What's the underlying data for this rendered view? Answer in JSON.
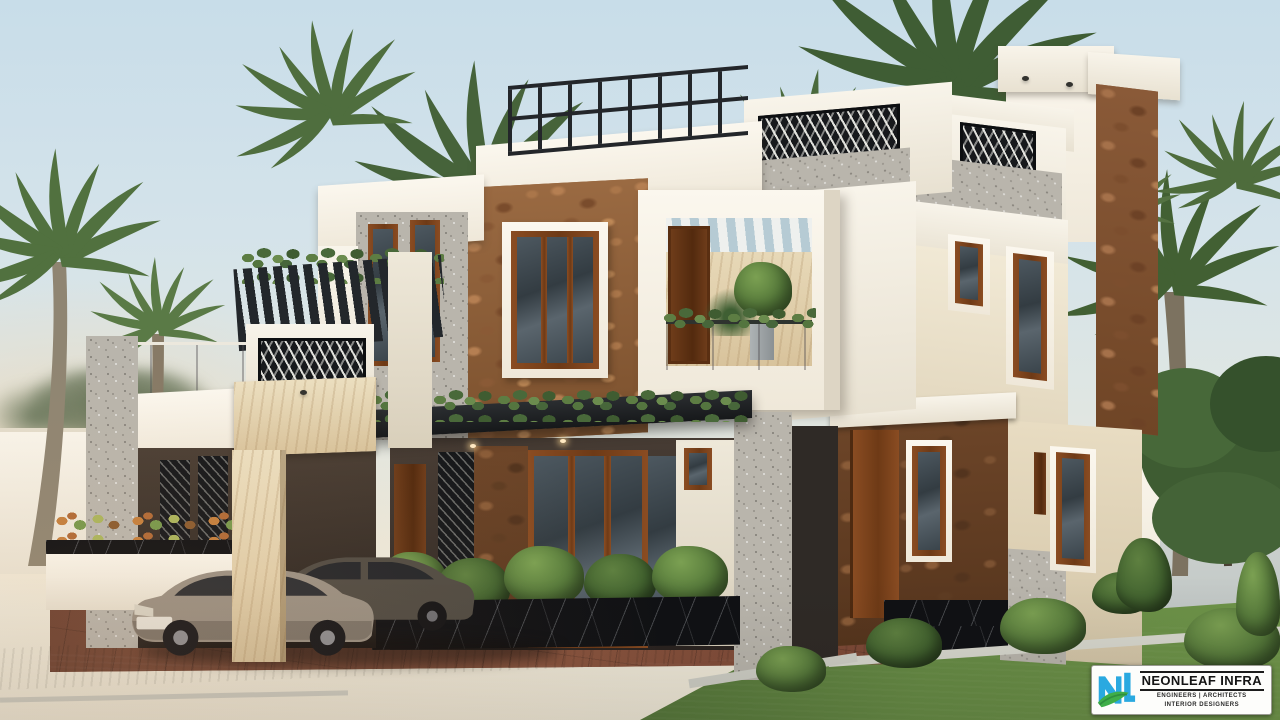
{
  "scene": {
    "label": "Photorealistic 3D exterior render of a modern two-storey residence at dusk",
    "setting": "Tropical landscaping with palm trees, lawn, stone-clad facade, carport with two cars, driveway and asphalt road"
  },
  "palette": {
    "sky_top": "#cbdfe9",
    "sky_horizon": "#f0e9d8",
    "wall_white": "#f4efe4",
    "wall_cream": "#ecdfc6",
    "stone_brown": "#8a5a38",
    "timber_brown": "#7c431d",
    "screen_black": "#1a1d20",
    "window_glass": "#39424a",
    "marble_beige": "#e6d6b4",
    "black_marble": "#101114",
    "lawn_green": "#5d8140",
    "road_asphalt": "#2c2f31",
    "paver_brown": "#7c4836",
    "car_grey": "#9a9083",
    "logo_blue": "#2aa9e0",
    "logo_green": "#3fae49"
  },
  "watermark": {
    "monogram": "NL",
    "company": "NEONLEAF INFRA",
    "tagline_1": "ENGINEERS | ARCHITECTS",
    "tagline_2": "INTERIOR DESIGNERS"
  }
}
